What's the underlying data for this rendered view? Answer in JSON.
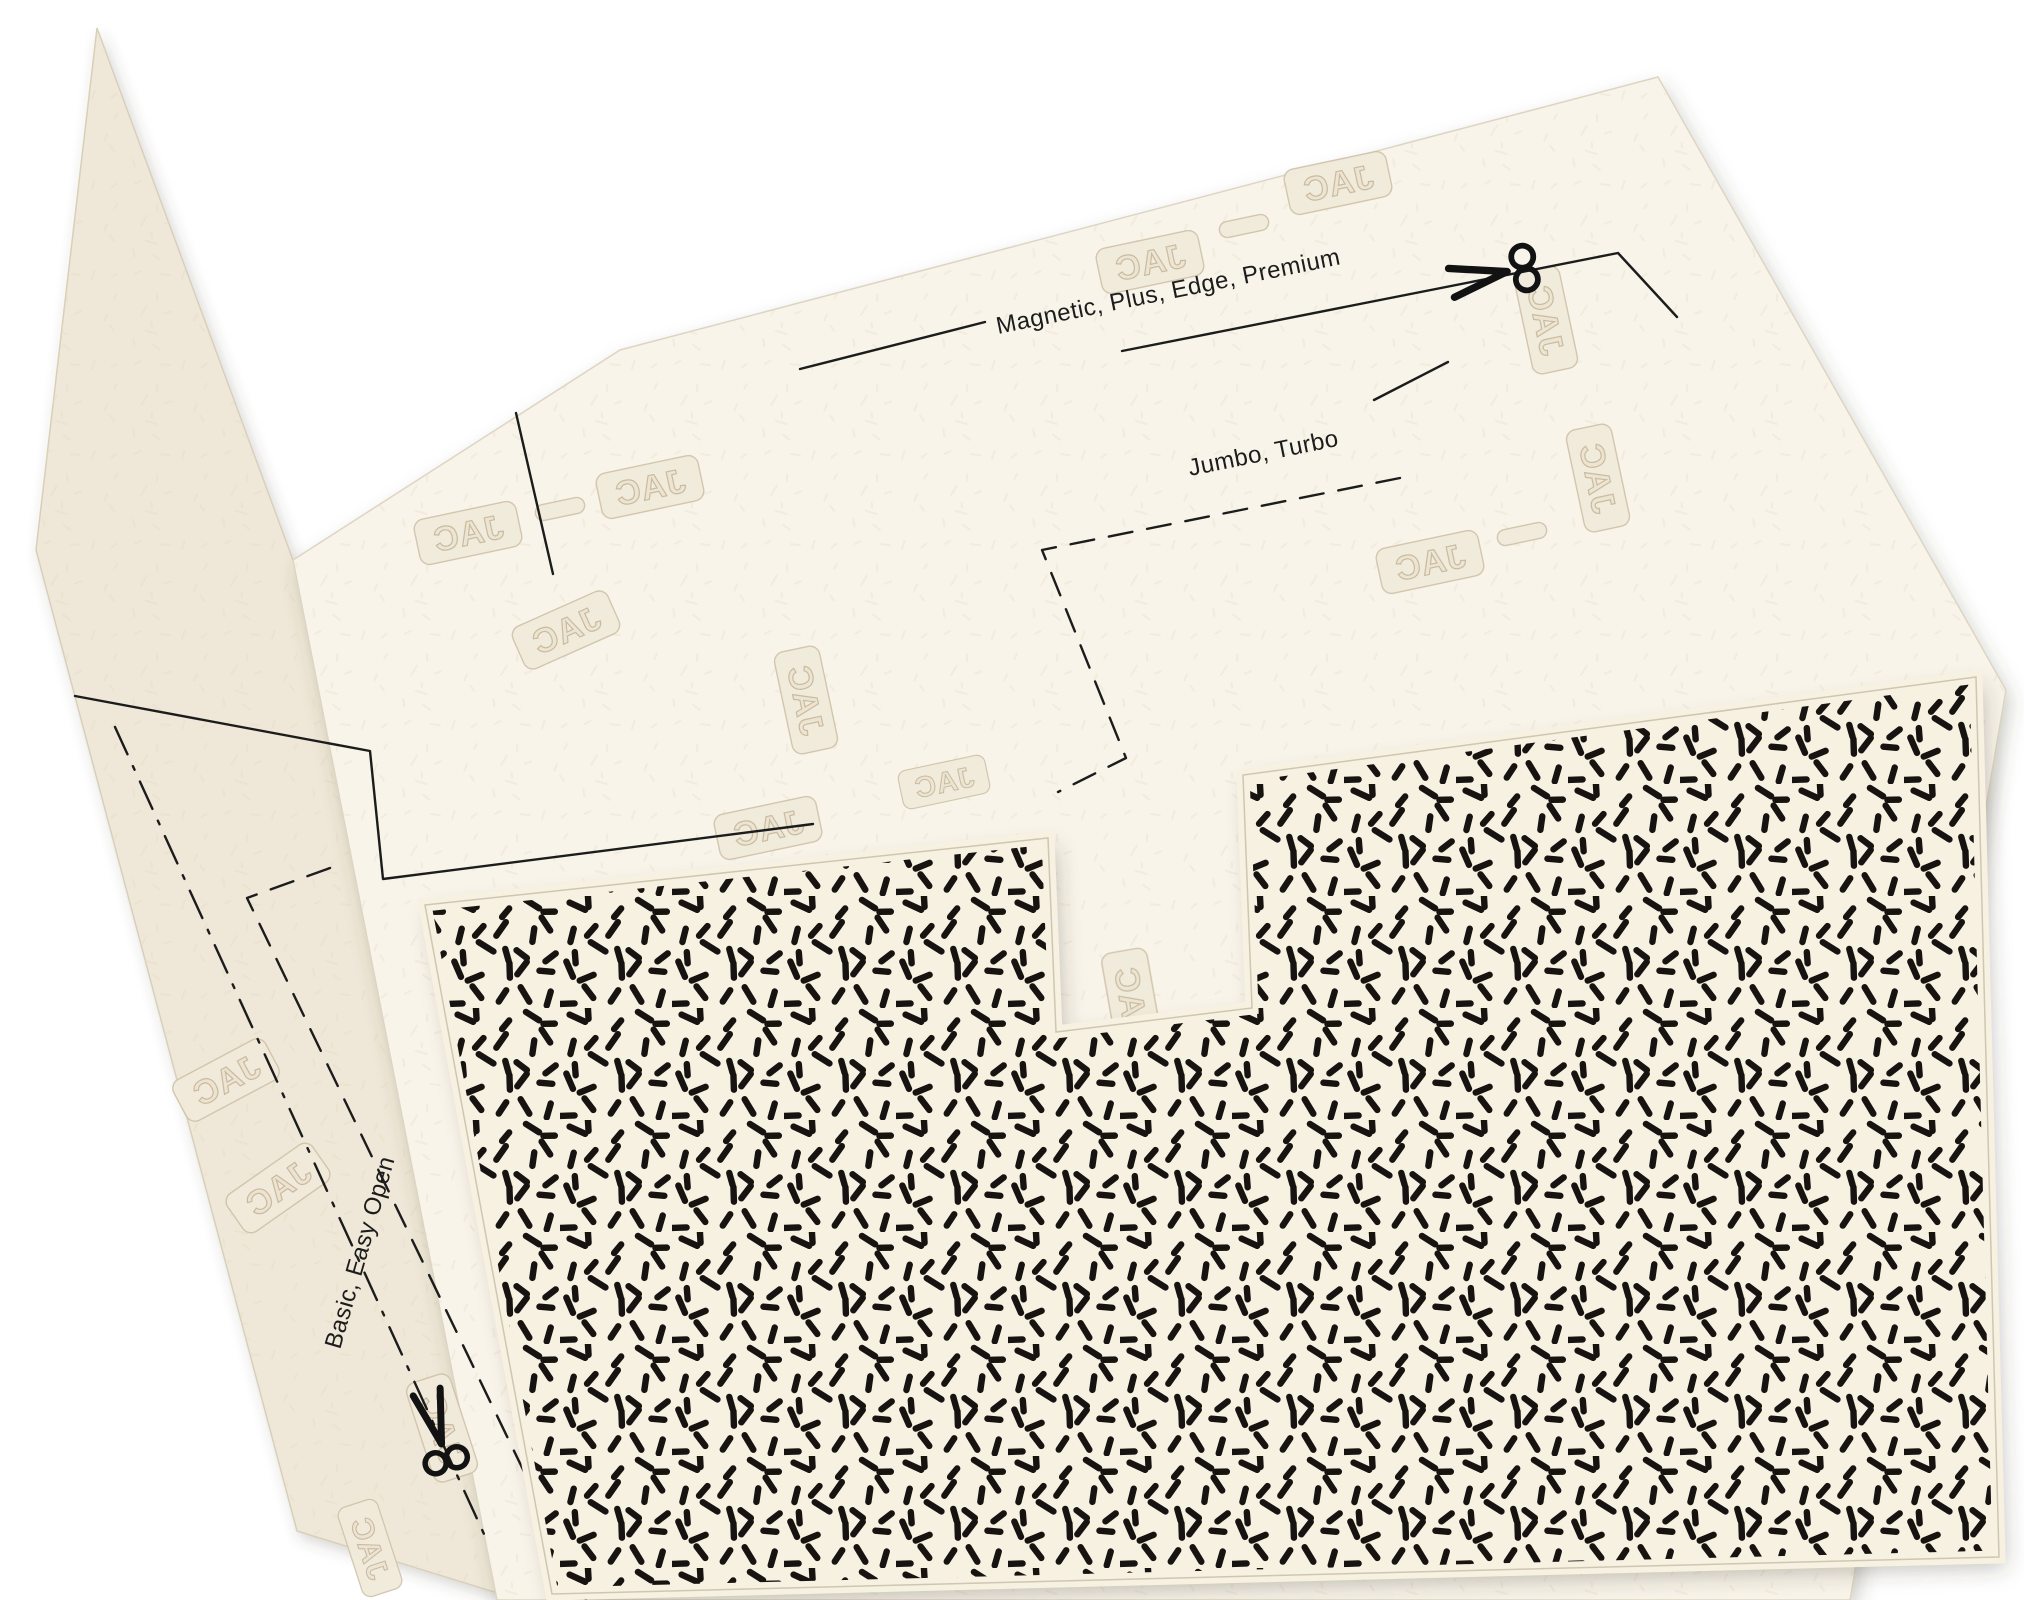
{
  "photo": {
    "kind": "photograph of paper cutting templates",
    "labels": {
      "magnetic": "Magnetic, Plus, Edge, Premium",
      "jumbo": "Jumbo, Turbo",
      "basic": "Basic, Easy Open"
    },
    "watermark": {
      "text": "JAC"
    },
    "colors": {
      "background": "#ffffff",
      "front_sheet": "#f8f4ea",
      "back_sheet": "#efe8d8",
      "pattern_sheet_base": "#f7f1e2",
      "sprinkle": "#171310",
      "line": "#1c1c1c",
      "sheet_edge": "#d8cfbb",
      "wm_fill": "#f1eadb",
      "wm_stroke": "#d0c3ab",
      "wm_letter_fill": "#ece3d0",
      "wm_letter_stroke": "#c6b89d",
      "texture_mark": "#e8dfca"
    }
  }
}
